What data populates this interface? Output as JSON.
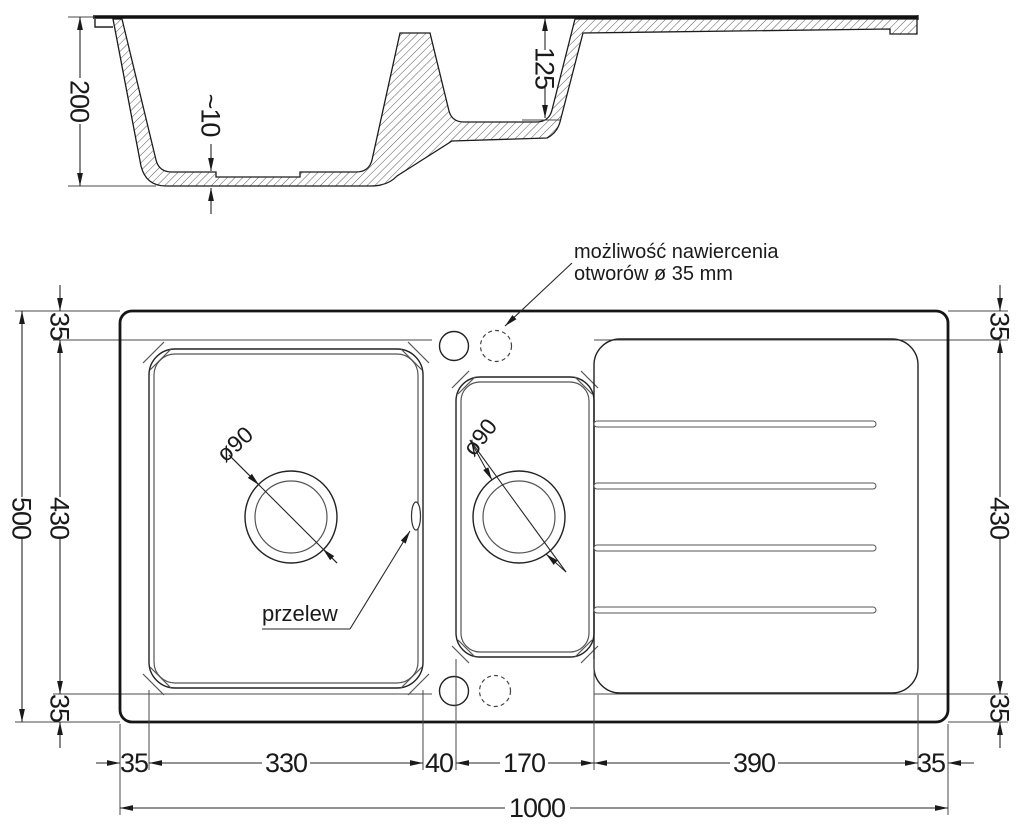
{
  "colors": {
    "line": "#1a1a1a",
    "background": "#ffffff"
  },
  "cross_section": {
    "depth_total": "200",
    "floor_thickness": "~10",
    "small_bowl_depth": "125"
  },
  "plan": {
    "labels": {
      "holes_line1": "możliwość nawiercenia",
      "holes_line2": "otworów ø 35 mm",
      "overflow": "przelew",
      "main_drain": "ø90",
      "small_drain": "ø90"
    },
    "dims": {
      "left_total": "500",
      "left": [
        "35",
        "430",
        "35"
      ],
      "right": [
        "35",
        "430",
        "35"
      ],
      "bottom": [
        "35",
        "330",
        "40",
        "170",
        "390",
        "35"
      ],
      "bottom_total": "1000"
    }
  }
}
